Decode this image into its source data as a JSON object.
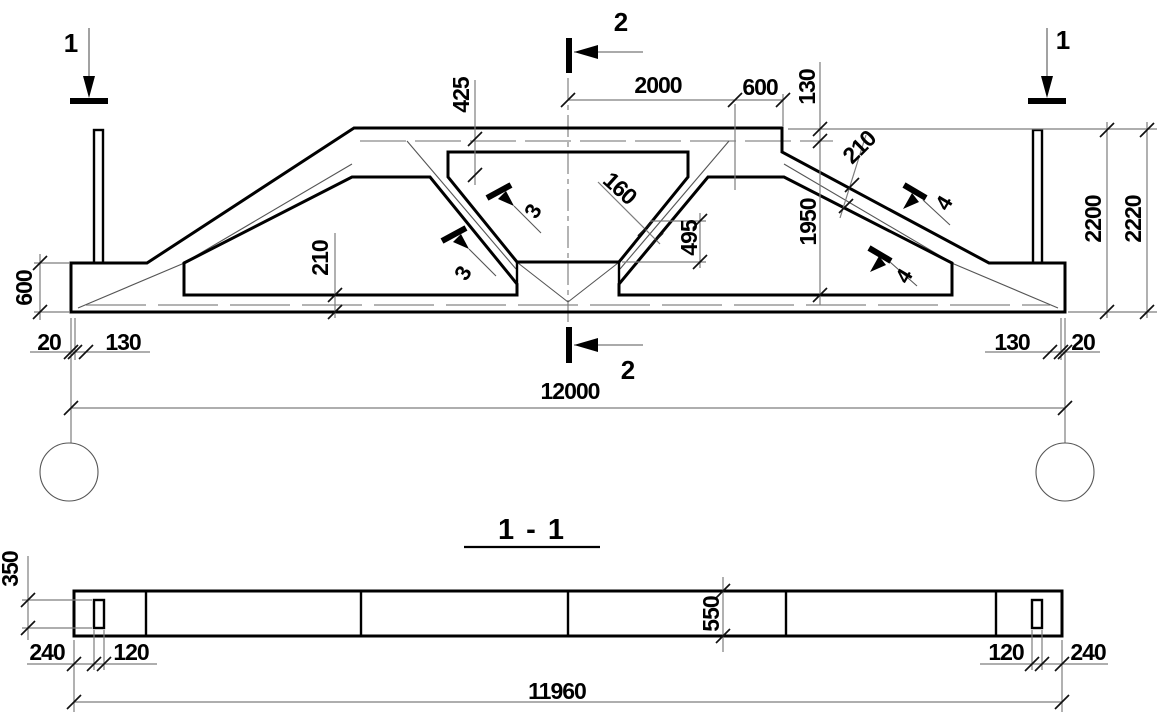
{
  "view_labels": {
    "section_title": "1 - 1"
  },
  "markers": {
    "m1_left": "1",
    "m1_right": "1",
    "m2_top": "2",
    "m2_bottom": "2",
    "m3_upper": "3",
    "m3_lower": "3",
    "m4_upper": "4",
    "m4_lower": "4"
  },
  "elevation_dims": {
    "top_2000": "2000",
    "top_600": "600",
    "right_130": "130",
    "right_1950": "1950",
    "right_2200": "2200",
    "right_2220": "2220",
    "haunch_425": "425",
    "web_160": "160",
    "node_495": "495",
    "chord_210": "210",
    "slope_210": "210",
    "left_600": "600",
    "left_20": "20",
    "left_130": "130",
    "bottom_right_130": "130",
    "bottom_right_20": "20",
    "span_12000": "12000"
  },
  "section_dims": {
    "slot_350": "350",
    "end_240_left": "240",
    "slot_120_left": "120",
    "depth_550": "550",
    "slot_120_right": "120",
    "end_240_right": "240",
    "length_11960": "11960"
  }
}
